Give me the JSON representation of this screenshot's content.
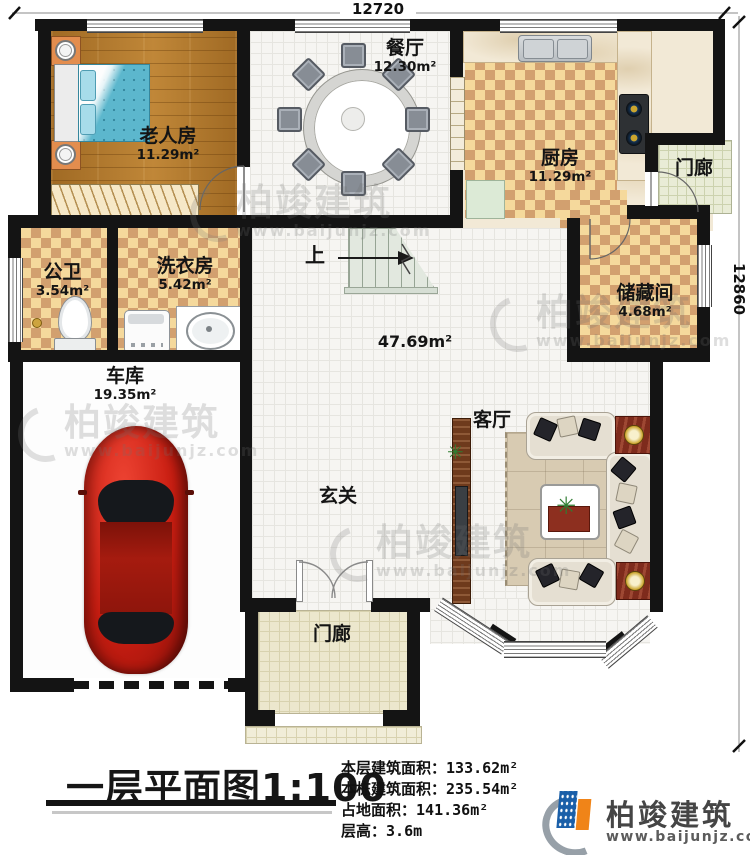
{
  "dimensions": {
    "top": "12720",
    "right": "12860"
  },
  "rooms": {
    "bedroom": {
      "name": "老人房",
      "area": "11.29m²"
    },
    "dining": {
      "name": "餐厅",
      "area": "12.30m²"
    },
    "kitchen": {
      "name": "厨房",
      "area": "11.29m²"
    },
    "porch_top": {
      "name": "门廊"
    },
    "storage": {
      "name": "储藏间",
      "area": "4.68m²"
    },
    "bathroom": {
      "name": "公卫",
      "area": "3.54m²"
    },
    "laundry": {
      "name": "洗衣房",
      "area": "5.42m²"
    },
    "garage": {
      "name": "车库",
      "area": "19.35m²"
    },
    "hall": {
      "area": "47.69m²"
    },
    "living": {
      "name": "客厅"
    },
    "foyer": {
      "name": "玄关"
    },
    "porch_bottom": {
      "name": "门廊"
    },
    "stairs": {
      "label": "上"
    }
  },
  "title": {
    "text": "一层平面图",
    "scale": "1:100"
  },
  "stats": [
    {
      "label": "本层建筑面积：",
      "value": "133.62m²"
    },
    {
      "label": "本栋建筑面积：",
      "value": "235.54m²"
    },
    {
      "label": "占地面积：",
      "value": "141.36m²"
    },
    {
      "label": "层高：",
      "value": "3.6m"
    }
  ],
  "logo": {
    "name": "柏竣建筑",
    "url": "www.baijunjz.com"
  },
  "watermark": {
    "text": "柏竣建筑",
    "url": "www.baijunjz.com"
  },
  "colors": {
    "wall": "#141414",
    "checker_light": "#f5d99c",
    "checker_dark": "#d2a06f",
    "wood": "#ae762e",
    "accent_blue": "#1a5fa8",
    "accent_orange": "#f08418",
    "car_red": "#c81d11"
  }
}
